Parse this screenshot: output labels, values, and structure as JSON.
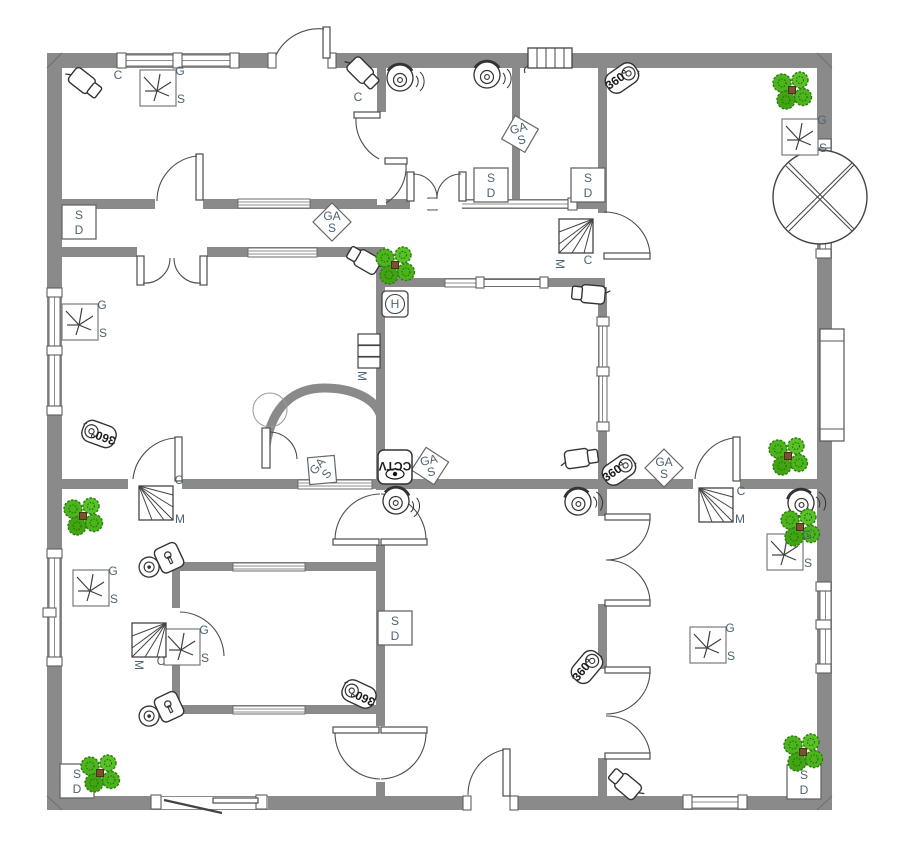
{
  "plan": {
    "kind": "security-and-access-floor-plan",
    "colors": {
      "wall": "#8a8a8a",
      "outline": "#4d4d4d",
      "device_outline": "#333333",
      "label": "#4c6372",
      "plant_green": "#4cb41d",
      "plant_dark": "#2e7d0e",
      "plant_center": "#7a5230",
      "floor": "#ffffff"
    }
  },
  "type_names": {
    "circle_x": "ceiling-fixture",
    "radiator": "wall-grille",
    "gs_box": "gs-sensor",
    "sd_box": "smoke-detector",
    "gas_diamond": "gas-detector",
    "motion_box": "motion-detector",
    "h_box": "h-sensor",
    "cctv_box": "cctv-monitor",
    "m_stack": "control-unit",
    "cam360": "camera-360",
    "bullet_cam": "security-camera",
    "dome_cam": "dome-camera",
    "lock_cam": "secure-camera",
    "plant": "potted-plant"
  },
  "devices": [
    {
      "type": "circle_x",
      "x": 820,
      "y": 197,
      "rot": 0
    },
    {
      "type": "radiator",
      "x": 550,
      "y": 58,
      "rot": 0
    },
    {
      "type": "gs_box",
      "x": 158,
      "y": 88,
      "rot": 0,
      "labels": [
        {
          "text": "G",
          "dx": 22,
          "dy": -13
        },
        {
          "text": "S",
          "dx": 23,
          "dy": 15
        }
      ]
    },
    {
      "type": "gs_box",
      "x": 800,
      "y": 137,
      "rot": 0,
      "labels": [
        {
          "text": "G",
          "dx": 22,
          "dy": -13
        },
        {
          "text": "S",
          "dx": 23,
          "dy": 15
        }
      ]
    },
    {
      "type": "gs_box",
      "x": 80,
      "y": 322,
      "rot": 0,
      "labels": [
        {
          "text": "G",
          "dx": 22,
          "dy": -13
        },
        {
          "text": "S",
          "dx": 23,
          "dy": 15
        }
      ]
    },
    {
      "type": "gs_box",
      "x": 91,
      "y": 588,
      "rot": 0,
      "labels": [
        {
          "text": "G",
          "dx": 22,
          "dy": -13
        },
        {
          "text": "S",
          "dx": 23,
          "dy": 15
        }
      ]
    },
    {
      "type": "gs_box",
      "x": 182,
      "y": 647,
      "rot": 0,
      "labels": [
        {
          "text": "G",
          "dx": 22,
          "dy": -13
        },
        {
          "text": "S",
          "dx": 23,
          "dy": 15
        }
      ]
    },
    {
      "type": "gs_box",
      "x": 708,
      "y": 645,
      "rot": 0,
      "labels": [
        {
          "text": "G",
          "dx": 22,
          "dy": -13
        },
        {
          "text": "S",
          "dx": 23,
          "dy": 15
        }
      ]
    },
    {
      "type": "gs_box",
      "x": 785,
      "y": 552,
      "rot": 0,
      "labels": [
        {
          "text": "G",
          "dx": 22,
          "dy": -13
        },
        {
          "text": "S",
          "dx": 23,
          "dy": 15
        }
      ]
    },
    {
      "type": "sd_box",
      "x": 79,
      "y": 222,
      "rot": 0,
      "labels": [
        {
          "text": "S",
          "dx": 0,
          "dy": -3,
          "fs": 13,
          "inFrame": true
        },
        {
          "text": "D",
          "dx": 0,
          "dy": 12,
          "fs": 13,
          "inFrame": true
        }
      ]
    },
    {
      "type": "sd_box",
      "x": 491,
      "y": 185,
      "rot": 0,
      "labels": [
        {
          "text": "S",
          "dx": 0,
          "dy": -3,
          "fs": 13,
          "inFrame": true
        },
        {
          "text": "D",
          "dx": 0,
          "dy": 12,
          "fs": 13,
          "inFrame": true
        }
      ]
    },
    {
      "type": "sd_box",
      "x": 588,
      "y": 185,
      "rot": 0,
      "labels": [
        {
          "text": "S",
          "dx": 0,
          "dy": -3,
          "fs": 13,
          "inFrame": true
        },
        {
          "text": "D",
          "dx": 0,
          "dy": 12,
          "fs": 13,
          "inFrame": true
        }
      ]
    },
    {
      "type": "sd_box",
      "x": 395,
      "y": 628,
      "rot": 0,
      "labels": [
        {
          "text": "S",
          "dx": 0,
          "dy": -3,
          "fs": 13,
          "inFrame": true
        },
        {
          "text": "D",
          "dx": 0,
          "dy": 12,
          "fs": 13,
          "inFrame": true
        }
      ]
    },
    {
      "type": "sd_box",
      "x": 77,
      "y": 781,
      "rot": 0,
      "labels": [
        {
          "text": "S",
          "dx": 0,
          "dy": -3,
          "fs": 13,
          "inFrame": true
        },
        {
          "text": "D",
          "dx": 0,
          "dy": 12,
          "fs": 13,
          "inFrame": true
        }
      ]
    },
    {
      "type": "sd_box",
      "x": 804,
      "y": 782,
      "rot": 0,
      "labels": [
        {
          "text": "S",
          "dx": 0,
          "dy": -3,
          "fs": 13,
          "inFrame": true
        },
        {
          "text": "D",
          "dx": 0,
          "dy": 12,
          "fs": 13,
          "inFrame": true
        }
      ]
    },
    {
      "type": "gas_diamond",
      "x": 332,
      "y": 222,
      "rot": 0,
      "labels": [
        {
          "text": "GA",
          "dx": 0,
          "dy": -2,
          "fs": 9,
          "inFrame": true
        },
        {
          "text": "S",
          "dx": 0,
          "dy": 10,
          "fs": 10,
          "inFrame": true
        }
      ]
    },
    {
      "type": "gas_diamond",
      "x": 520,
      "y": 134,
      "rot": -15,
      "labels": [
        {
          "text": "GA",
          "dx": 0,
          "dy": -2,
          "fs": 9,
          "inFrame": true
        },
        {
          "text": "S",
          "dx": 0,
          "dy": 10,
          "fs": 10,
          "inFrame": true
        }
      ]
    },
    {
      "type": "gas_diamond",
      "x": 322,
      "y": 470,
      "rot": -50,
      "labels": [
        {
          "text": "GA",
          "dx": 0,
          "dy": -2,
          "fs": 9,
          "inFrame": true
        },
        {
          "text": "S",
          "dx": 0,
          "dy": 10,
          "fs": 10,
          "inFrame": true
        }
      ]
    },
    {
      "type": "gas_diamond",
      "x": 430,
      "y": 466,
      "rot": -12,
      "labels": [
        {
          "text": "GA",
          "dx": 0,
          "dy": -2,
          "fs": 9,
          "inFrame": true
        },
        {
          "text": "S",
          "dx": 0,
          "dy": 10,
          "fs": 10,
          "inFrame": true
        }
      ]
    },
    {
      "type": "gas_diamond",
      "x": 664,
      "y": 468,
      "rot": 0,
      "labels": [
        {
          "text": "GA",
          "dx": 0,
          "dy": -2,
          "fs": 9,
          "inFrame": true
        },
        {
          "text": "S",
          "dx": 0,
          "dy": 10,
          "fs": 10,
          "inFrame": true
        }
      ]
    },
    {
      "type": "motion_box",
      "x": 576,
      "y": 236,
      "rot": 90,
      "labels": [
        {
          "text": "M",
          "dx": -20,
          "dy": 28,
          "rot": 90
        },
        {
          "text": "C",
          "dx": 12,
          "dy": 28
        }
      ]
    },
    {
      "type": "motion_box",
      "x": 156,
      "y": 503,
      "rot": 0,
      "labels": [
        {
          "text": "C",
          "dx": 23,
          "dy": -19
        },
        {
          "text": "M",
          "dx": 24,
          "dy": 20
        }
      ]
    },
    {
      "type": "motion_box",
      "x": 716,
      "y": 505,
      "rot": 0,
      "labels": [
        {
          "text": "C",
          "dx": 25,
          "dy": -10
        },
        {
          "text": "M",
          "dx": 24,
          "dy": 18
        }
      ]
    },
    {
      "type": "motion_box",
      "x": 149,
      "y": 640,
      "rot": 90,
      "labels": [
        {
          "text": "M",
          "dx": -14,
          "dy": 25,
          "rot": 90
        },
        {
          "text": "C",
          "dx": 12,
          "dy": 25
        }
      ]
    },
    {
      "type": "h_box",
      "x": 395,
      "y": 304,
      "rot": 0,
      "labels": [
        {
          "text": "H",
          "dx": 0,
          "dy": 4,
          "fs": 11,
          "inFrame": true
        }
      ]
    },
    {
      "type": "cctv_box",
      "x": 395,
      "y": 467,
      "rot": 0,
      "labels": [
        {
          "text": "CCTV",
          "dx": 0,
          "dy": -5,
          "fs": 8,
          "rot": 180,
          "inFrame": true,
          "cls": "dark"
        }
      ]
    },
    {
      "type": "m_stack",
      "x": 369,
      "y": 351,
      "rot": 0,
      "labels": [
        {
          "text": "M",
          "dx": -11,
          "dy": 25,
          "rot": 90
        }
      ]
    },
    {
      "type": "cam360",
      "x": 622,
      "y": 78,
      "rot": -35,
      "labels": [
        {
          "text": "360°",
          "dx": -5,
          "dy": 2.5,
          "fs": 6.5,
          "inFrame": true,
          "cls": "dark"
        }
      ]
    },
    {
      "type": "cam360",
      "x": 99,
      "y": 434,
      "rot": 200,
      "labels": [
        {
          "text": "360°",
          "dx": -5,
          "dy": 2.5,
          "fs": 6.5,
          "inFrame": true,
          "cls": "dark"
        }
      ]
    },
    {
      "type": "cam360",
      "x": 619,
      "y": 470,
      "rot": -35,
      "labels": [
        {
          "text": "360°",
          "dx": -5,
          "dy": 2.5,
          "fs": 6.5,
          "inFrame": true,
          "cls": "dark"
        }
      ]
    },
    {
      "type": "cam360",
      "x": 587,
      "y": 667,
      "rot": -50,
      "labels": [
        {
          "text": "360°",
          "dx": -5,
          "dy": 2.5,
          "fs": 6.5,
          "inFrame": true,
          "cls": "dark"
        }
      ]
    },
    {
      "type": "cam360",
      "x": 359,
      "y": 694,
      "rot": 205,
      "labels": [
        {
          "text": "360°",
          "dx": -5,
          "dy": 2.5,
          "fs": 6.5,
          "inFrame": true,
          "cls": "dark"
        }
      ]
    },
    {
      "type": "bullet_cam",
      "x": 85,
      "y": 83,
      "rot": 38,
      "labels": [
        {
          "text": "C",
          "dx": 33,
          "dy": -4
        }
      ]
    },
    {
      "type": "bullet_cam",
      "x": 363,
      "y": 73,
      "rot": 45,
      "labels": [
        {
          "text": "C",
          "dx": -5,
          "dy": 28,
          "fs": 10
        }
      ]
    },
    {
      "type": "bullet_cam",
      "x": 364,
      "y": 260,
      "rot": 210
    },
    {
      "type": "bullet_cam",
      "x": 589,
      "y": 294,
      "rot": 185
    },
    {
      "type": "bullet_cam",
      "x": 581,
      "y": 458,
      "rot": -8
    },
    {
      "type": "bullet_cam",
      "x": 625,
      "y": 784,
      "rot": 220
    },
    {
      "type": "dome_cam",
      "x": 400,
      "y": 78,
      "rot": 0
    },
    {
      "type": "dome_cam",
      "x": 487,
      "y": 75,
      "rot": 0
    },
    {
      "type": "dome_cam",
      "x": 396,
      "y": 501,
      "rot": 8
    },
    {
      "type": "dome_cam",
      "x": 578,
      "y": 502,
      "rot": -12
    },
    {
      "type": "dome_cam",
      "x": 801,
      "y": 503,
      "rot": -15
    },
    {
      "type": "lock_cam",
      "x": 160,
      "y": 562,
      "rot": -25
    },
    {
      "type": "lock_cam",
      "x": 160,
      "y": 711,
      "rot": -25
    },
    {
      "type": "plant",
      "x": 792,
      "y": 90
    },
    {
      "type": "plant",
      "x": 395,
      "y": 265
    },
    {
      "type": "plant",
      "x": 788,
      "y": 456
    },
    {
      "type": "plant",
      "x": 800,
      "y": 527
    },
    {
      "type": "plant",
      "x": 83,
      "y": 516
    },
    {
      "type": "plant",
      "x": 100,
      "y": 773
    },
    {
      "type": "plant",
      "x": 803,
      "y": 752
    }
  ]
}
